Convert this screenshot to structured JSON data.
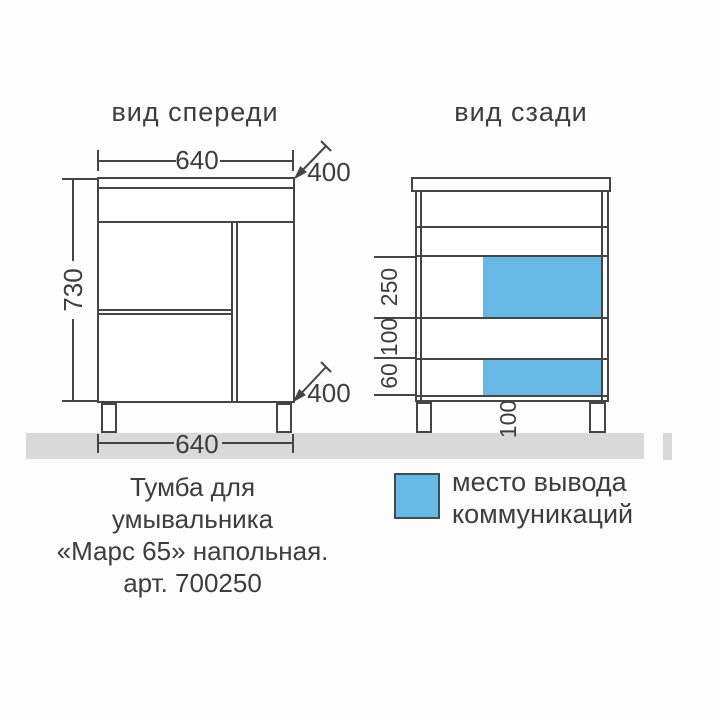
{
  "colors": {
    "line": "#454545",
    "text": "#3d3d3d",
    "floor": "#d9d9d9",
    "zone_blue": "#65b9e4",
    "swatch_border": "#3e4c55"
  },
  "front_view": {
    "title": "вид спереди",
    "dims": {
      "width_top": "640",
      "height": "730",
      "depth_top": "400",
      "depth_bottom": "400",
      "width_bottom": "640"
    }
  },
  "back_view": {
    "title": "вид сзади",
    "dims": {
      "zone_height": "250",
      "zone_gap": "100",
      "zone_lower_height": "60",
      "zone_offset": "100"
    }
  },
  "legend": {
    "line1": "место вывода",
    "line2": "коммуникаций"
  },
  "caption": {
    "line1": "Тумба для",
    "line2": "умывальника",
    "line3": "«Марс 65» напольная.",
    "line4": "арт. 700250"
  }
}
